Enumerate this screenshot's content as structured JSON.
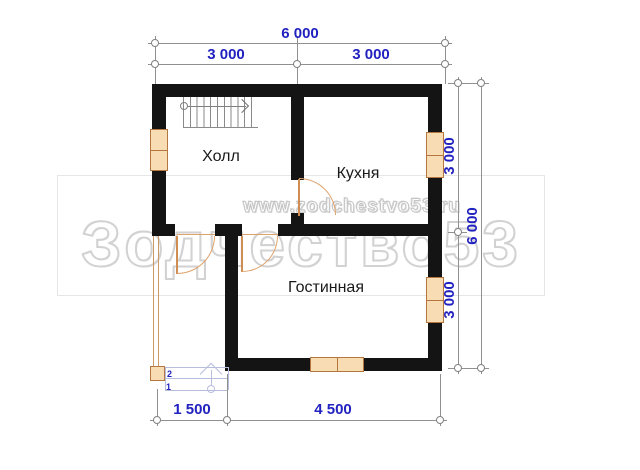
{
  "plan": {
    "rooms": {
      "hall": "Холл",
      "kitchen": "Кухня",
      "living": "Гостинная"
    },
    "dimensions": {
      "top_total": "6 000",
      "top_left": "3 000",
      "top_right": "3 000",
      "right_upper": "3 000",
      "right_lower": "3 000",
      "right_total": "6 000",
      "bottom_left": "1 500",
      "bottom_right": "4 500"
    },
    "entrance_steps": {
      "step_1": "1",
      "step_2": "2"
    }
  },
  "watermark": {
    "url": "www.zodchestvo53.ru",
    "brand": "Зодчество53"
  },
  "colors": {
    "wall": "#141414",
    "dimension_text": "#2222c0",
    "dimension_line": "#909090",
    "window_fill": "#f7dcb4",
    "window_frame": "#b5773f",
    "door_arc": "#e0a26b",
    "steps_line": "#b7bedd",
    "watermark_outline": "#d2d2d2"
  }
}
